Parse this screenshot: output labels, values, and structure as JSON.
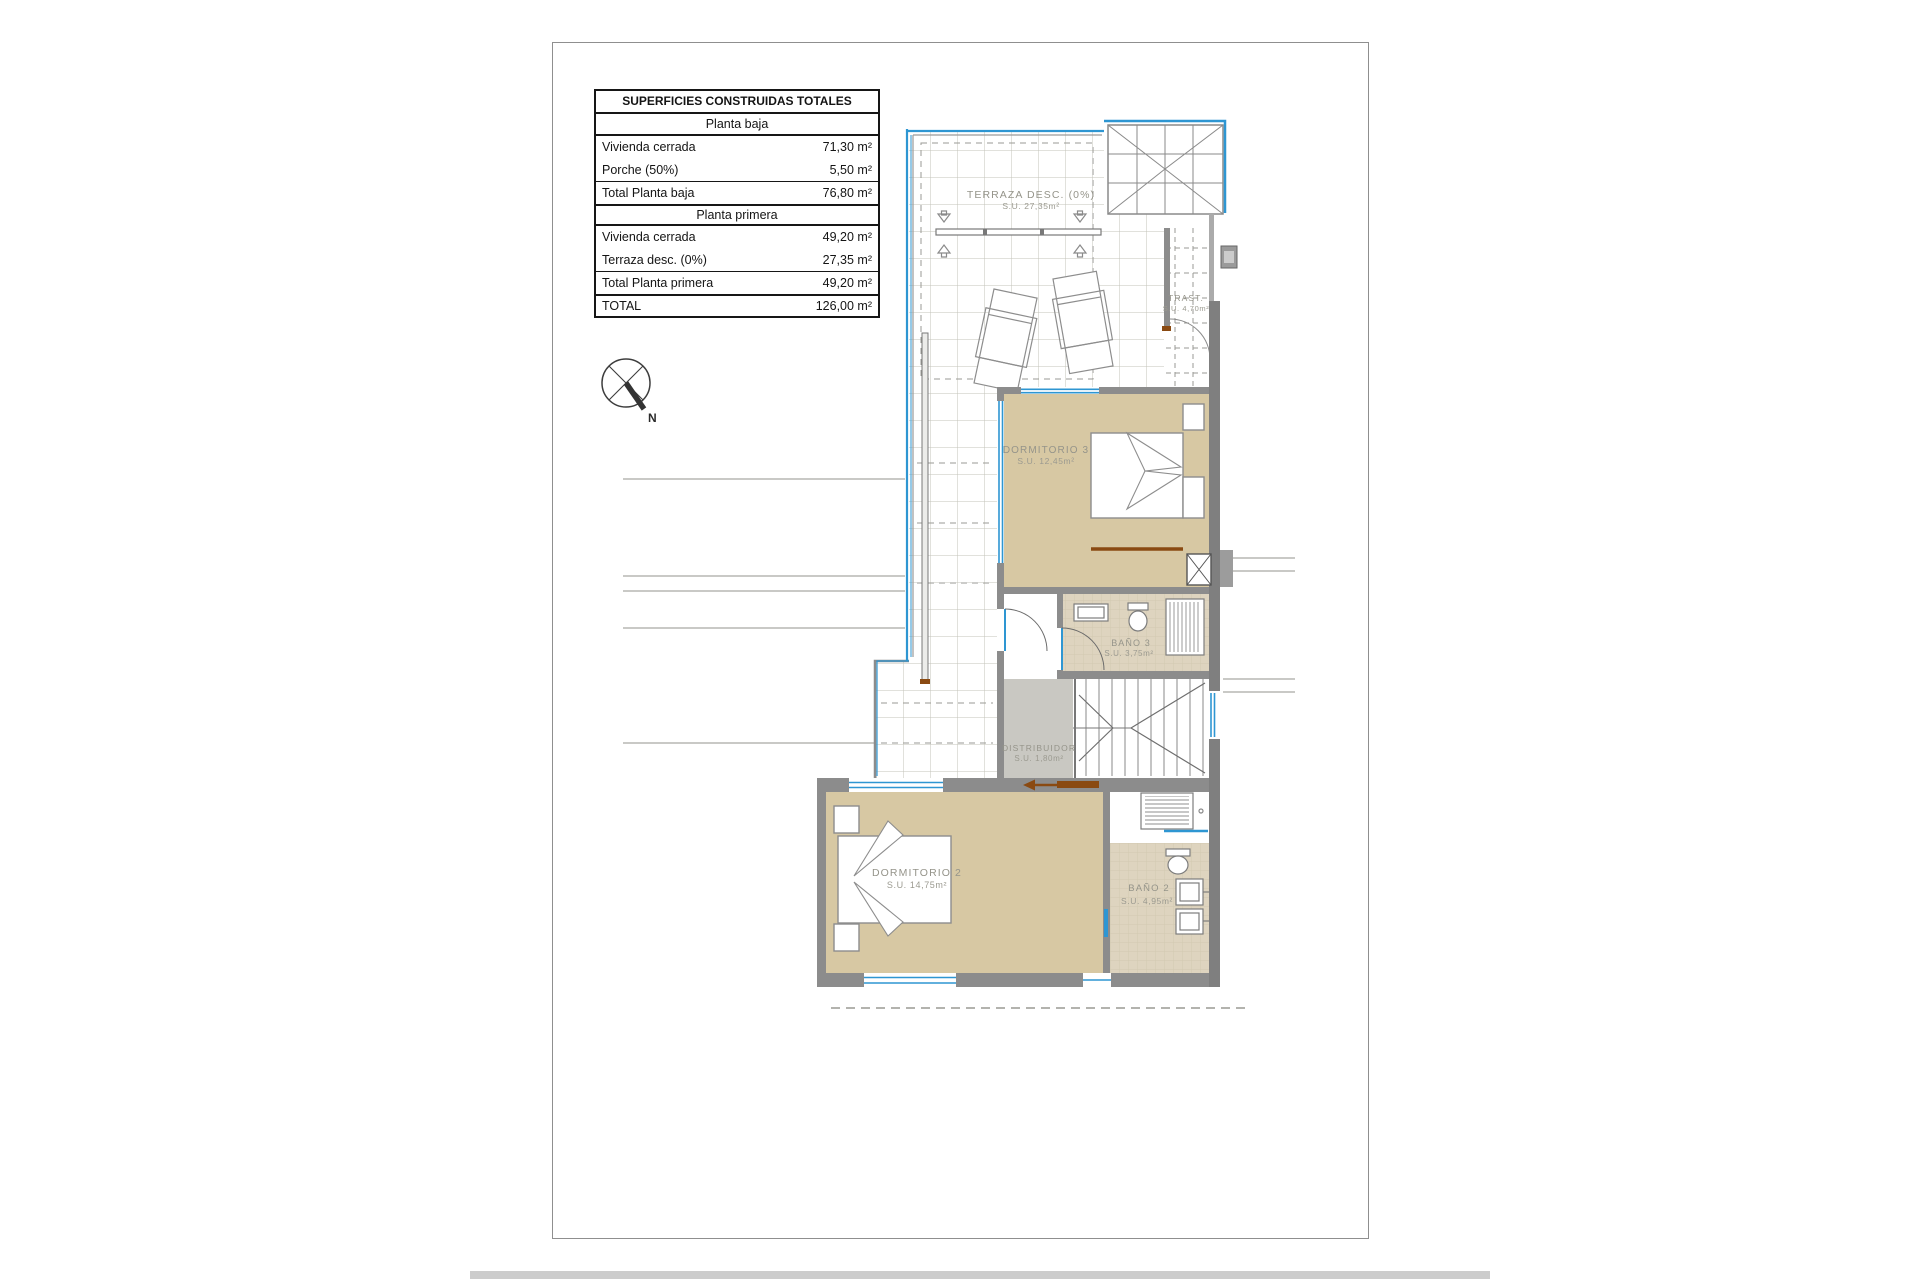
{
  "table": {
    "title": "SUPERFICIES CONSTRUIDAS TOTALES",
    "sections": {
      "baja": {
        "header": "Planta baja",
        "rows": [
          {
            "label": "Vivienda cerrada",
            "value": "71,30 m²"
          },
          {
            "label": "Porche (50%)",
            "value": "5,50 m²"
          }
        ],
        "total": {
          "label": "Total Planta baja",
          "value": "76,80 m²"
        }
      },
      "primera": {
        "header": "Planta primera",
        "rows": [
          {
            "label": "Vivienda cerrada",
            "value": "49,20 m²"
          },
          {
            "label": "Terraza desc. (0%)",
            "value": "27,35 m²"
          }
        ],
        "total": {
          "label": "Total Planta primera",
          "value": "49,20 m²"
        }
      }
    },
    "grand_total": {
      "label": "TOTAL",
      "value": "126,00 m²"
    }
  },
  "compass": {
    "north_label": "N"
  },
  "plan": {
    "rooms": {
      "terraza": {
        "name": "TERRAZA DESC. (0%)",
        "area": "S.U. 27,35m²"
      },
      "trastero": {
        "name": "TRAST.",
        "area": "S.U. 4,70m²"
      },
      "dormitorio3": {
        "name": "DORMITORIO 3",
        "area": "S.U. 12,45m²"
      },
      "bano3": {
        "name": "BAÑO 3",
        "area": "S.U. 3,75m²"
      },
      "distribuidor": {
        "name": "DISTRIBUIDOR",
        "area": "S.U. 1,80m²"
      },
      "dormitorio2": {
        "name": "DORMITORIO 2",
        "area": "S.U. 14,75m²"
      },
      "bano2": {
        "name": "BAÑO 2",
        "area": "S.U. 4,95m²"
      }
    },
    "colors": {
      "window_blue": "#2e96d2",
      "room_tan": "#d7c8a3",
      "bath_floor": "#ded4bf",
      "hall_gray": "#c9c8c2",
      "wall_gray": "#8c8c8c",
      "accent_brown": "#8a4a12"
    }
  }
}
